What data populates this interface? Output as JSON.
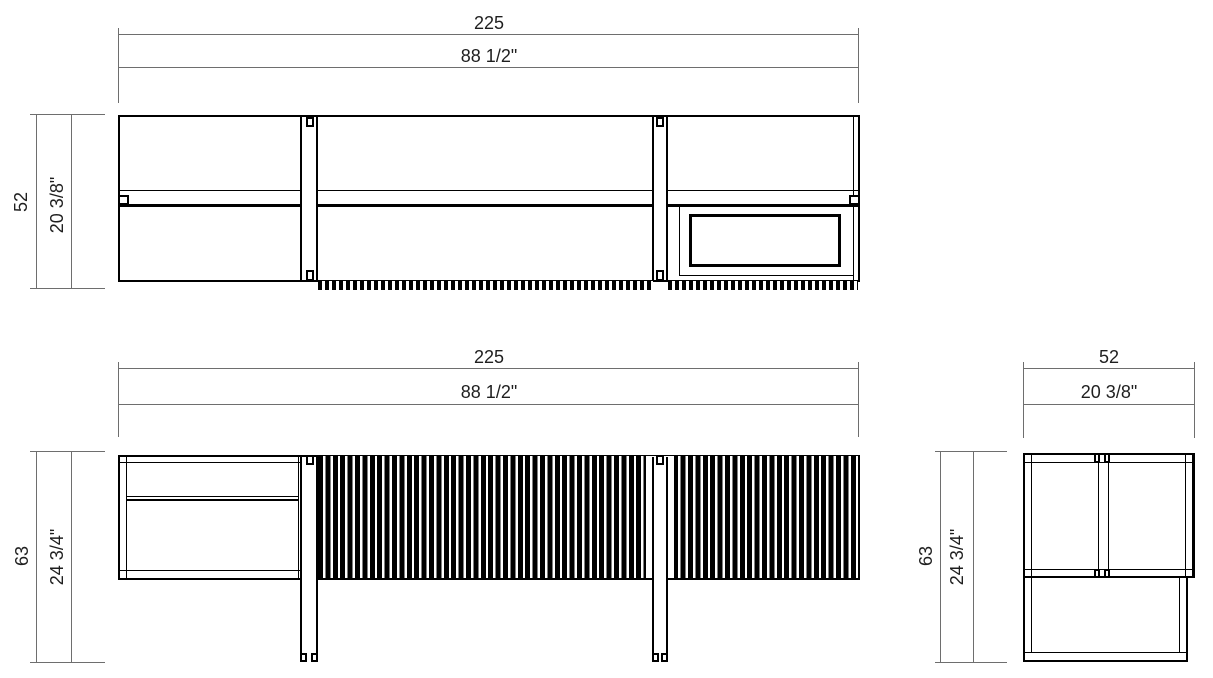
{
  "drawing": {
    "colors": {
      "object_line": "#000000",
      "dimension_line": "#6e6e6e",
      "text": "#1f1f1f",
      "background": "#ffffff"
    },
    "views": {
      "top": {
        "width_cm": "225",
        "width_in": "88 1/2\"",
        "depth_cm": "52",
        "depth_in": "20 3/8\""
      },
      "front": {
        "width_cm": "225",
        "width_in": "88 1/2\"",
        "height_cm": "63",
        "height_in": "24 3/4\""
      },
      "side": {
        "depth_cm": "52",
        "depth_in": "20 3/8\"",
        "height_cm": "63",
        "height_in": "24 3/4\""
      }
    }
  }
}
